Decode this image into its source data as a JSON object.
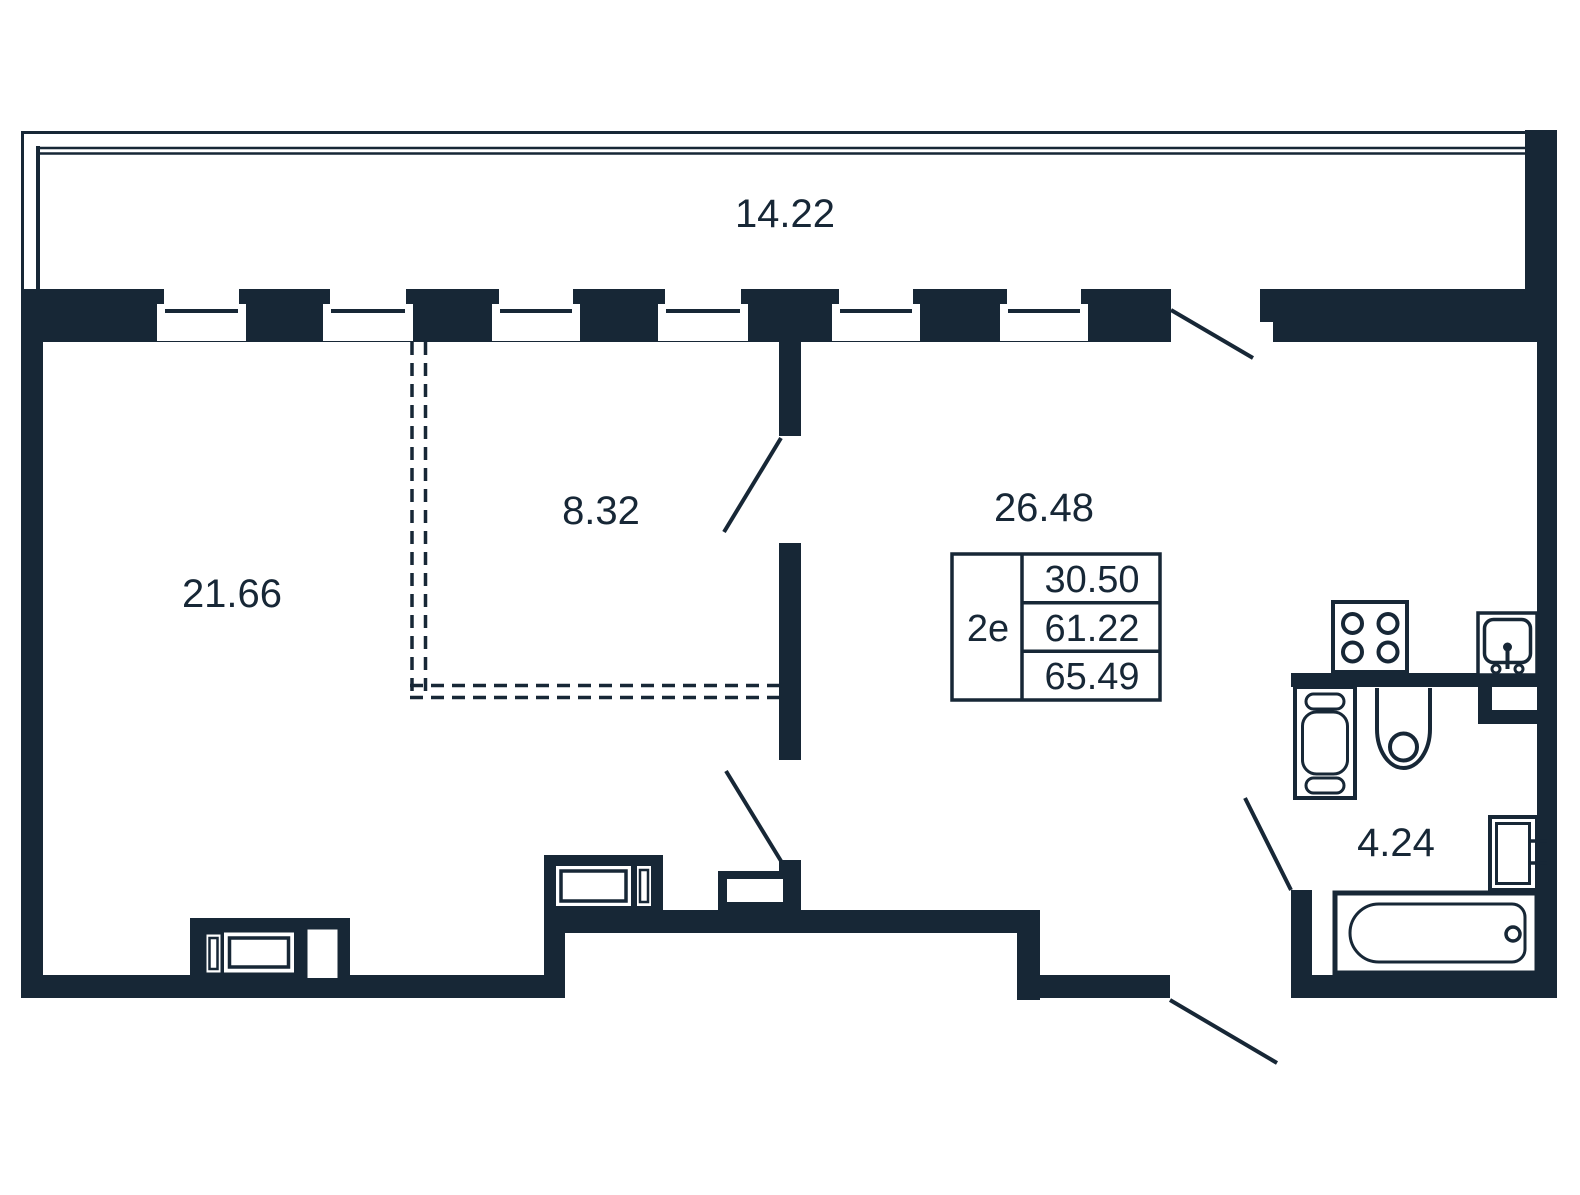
{
  "colors": {
    "ink": "#172736",
    "background": "#ffffff"
  },
  "plan": {
    "kind": "apartment floor plan"
  },
  "rooms": {
    "balcony": {
      "area_label": "14.22"
    },
    "living": {
      "area_label": "21.66"
    },
    "hall": {
      "area_label": "8.32"
    },
    "kitchen_living": {
      "area_label": "26.48"
    },
    "bathroom": {
      "area_label": "4.24"
    }
  },
  "info_table": {
    "unit_type": "2е",
    "values": [
      "30.50",
      "61.22",
      "65.49"
    ]
  },
  "fixtures": [
    "stove-icon",
    "kitchen-sink-icon",
    "washing-machine-icon",
    "toilet-icon",
    "washbasin-icon",
    "bathtub-icon",
    "dresser-icon",
    "cabinet-icon",
    "vent-duct-icon"
  ]
}
